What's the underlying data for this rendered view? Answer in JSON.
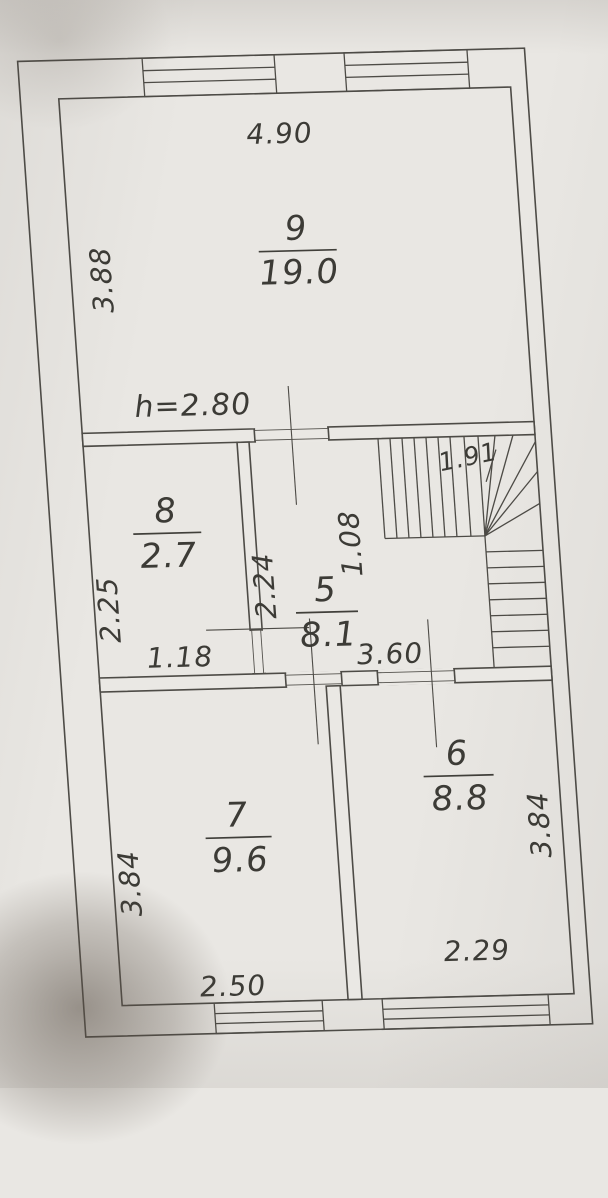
{
  "plan": {
    "type": "floor-plan",
    "rooms": [
      {
        "number": "9",
        "area": "19.0"
      },
      {
        "number": "8",
        "area": "2.7"
      },
      {
        "number": "5",
        "area": "8.1"
      },
      {
        "number": "7",
        "area": "9.6"
      },
      {
        "number": "6",
        "area": "8.8"
      }
    ],
    "height_note": "h=2.80",
    "dims": {
      "room9_width": "4.90",
      "room9_depth": "3.88",
      "room8_depth": "2.25",
      "room8_width": "1.18",
      "room5_depth": "2.24",
      "room5_width": "3.60",
      "stair_flight_depth": "1.08",
      "stair_width": "1.91",
      "room7_depth": "3.84",
      "room7_width": "2.50",
      "room6_depth": "3.84",
      "room6_width": "2.29"
    },
    "colors": {
      "paper": "#e9e7e3",
      "line": "#4d4b46",
      "text": "#3c3b36"
    }
  }
}
